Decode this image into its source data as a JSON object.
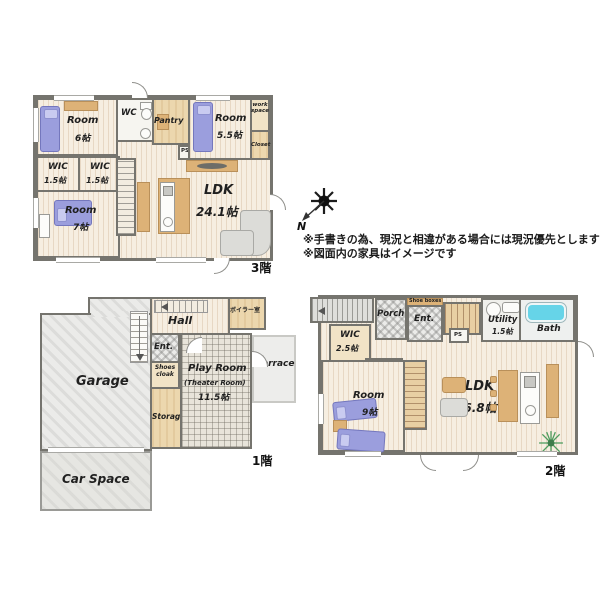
{
  "notes": {
    "line1": "※手書きの為、現況と相違がある場合には現況優先とします",
    "line2": "※図面内の家具はイメージです"
  },
  "compass": {
    "north": "N"
  },
  "floors": {
    "f3": {
      "label": "3階",
      "room6": {
        "name": "Room",
        "area": "6帖"
      },
      "wc": "WC",
      "pantry": "Pantry",
      "room55": {
        "name": "Room",
        "area": "5.5帖"
      },
      "workspace": "work space",
      "closet": "Closet",
      "ps": "PS",
      "wic_a": {
        "name": "WIC",
        "area": "1.5帖"
      },
      "wic_b": {
        "name": "WIC",
        "area": "1.5帖"
      },
      "room7": {
        "name": "Room",
        "area": "7帖"
      },
      "ldk": {
        "name": "LDK",
        "area": "24.1帖"
      }
    },
    "f1": {
      "label": "1階",
      "hall": "Hall",
      "boiler": "ボイラー室",
      "ent": "Ent.",
      "shoes_cloak": "Shoes cloak",
      "storage": "Storage",
      "garage": "Garage",
      "playroom": {
        "name": "Play Room",
        "sub": "(Theater Room)",
        "area": "11.5帖"
      },
      "terrace": "Terrace",
      "car_space": "Car Space"
    },
    "f2": {
      "label": "2階",
      "porch": "Porch",
      "shoe_boxes": "Shoe boxes",
      "ent": "Ent.",
      "ps": "PS",
      "utility": {
        "name": "Utility",
        "area": "1.5帖"
      },
      "bath": "Bath",
      "wic": {
        "name": "WIC",
        "area": "2.5帖"
      },
      "wc": "WC",
      "room9": {
        "name": "Room",
        "area": "9帖"
      },
      "ldk": {
        "name": "LDK",
        "area": "26.8帖"
      }
    }
  },
  "colors": {
    "wall": "#75746e",
    "wood": "#f6eee1",
    "beige": "#ecd7ae",
    "bed": "#9b9edd",
    "furniture": "#ddb277",
    "sofa": "#dcdcd8",
    "bathtub": "#66d4e8",
    "plant": "#4f9e60",
    "text": "#202020"
  }
}
